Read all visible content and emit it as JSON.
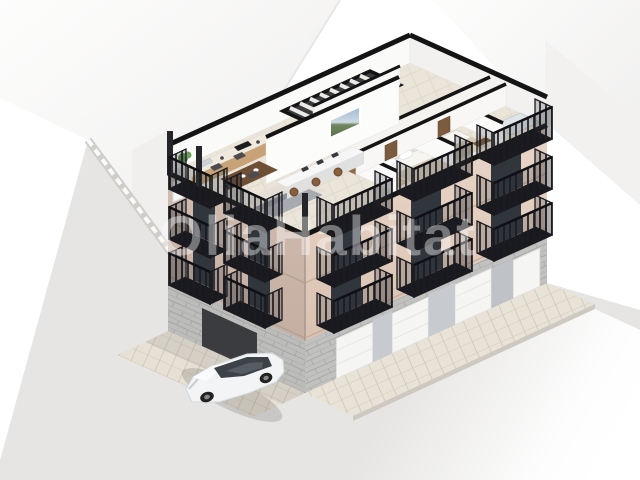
{
  "image": {
    "description": "3D isometric cutaway render of a corner residential building showing the top-floor furnished floor plan, balconies, garage doors and a parked car"
  },
  "watermark": {
    "text": "OliaHabitat",
    "color": "#ffffff",
    "opacity": 0.4
  },
  "palette": {
    "facade_left_bottom": "#c2aa9d",
    "facade_left_top": "#d0bcb0",
    "facade_right_bottom": "#d6bdac",
    "facade_right_top": "#e9d6c8",
    "stone": "#c0c0be",
    "railing": "#1b1b20",
    "window_glass": "#31363c",
    "plan_floor": "#eae4d9",
    "wall_white": "#fafaf9",
    "wall_cut_black": "#141414",
    "corridor_wood": "#96714f",
    "table_wood": "#6f4e36",
    "wardrobe_wood": "#ddcaac",
    "sofa_gray": "#a7abb0",
    "bed_blanket": "#d9cdbb",
    "street": "#e6e5e3",
    "sidewalk": "#e8e2d7",
    "garage_door": "#f5f5f3",
    "garage_panel": "#c7cbd0",
    "car_body": "#f3f4f5",
    "plant_green": "#5a8f4e",
    "picture_sky": "#9db9d4",
    "picture_land": "#55704a"
  }
}
